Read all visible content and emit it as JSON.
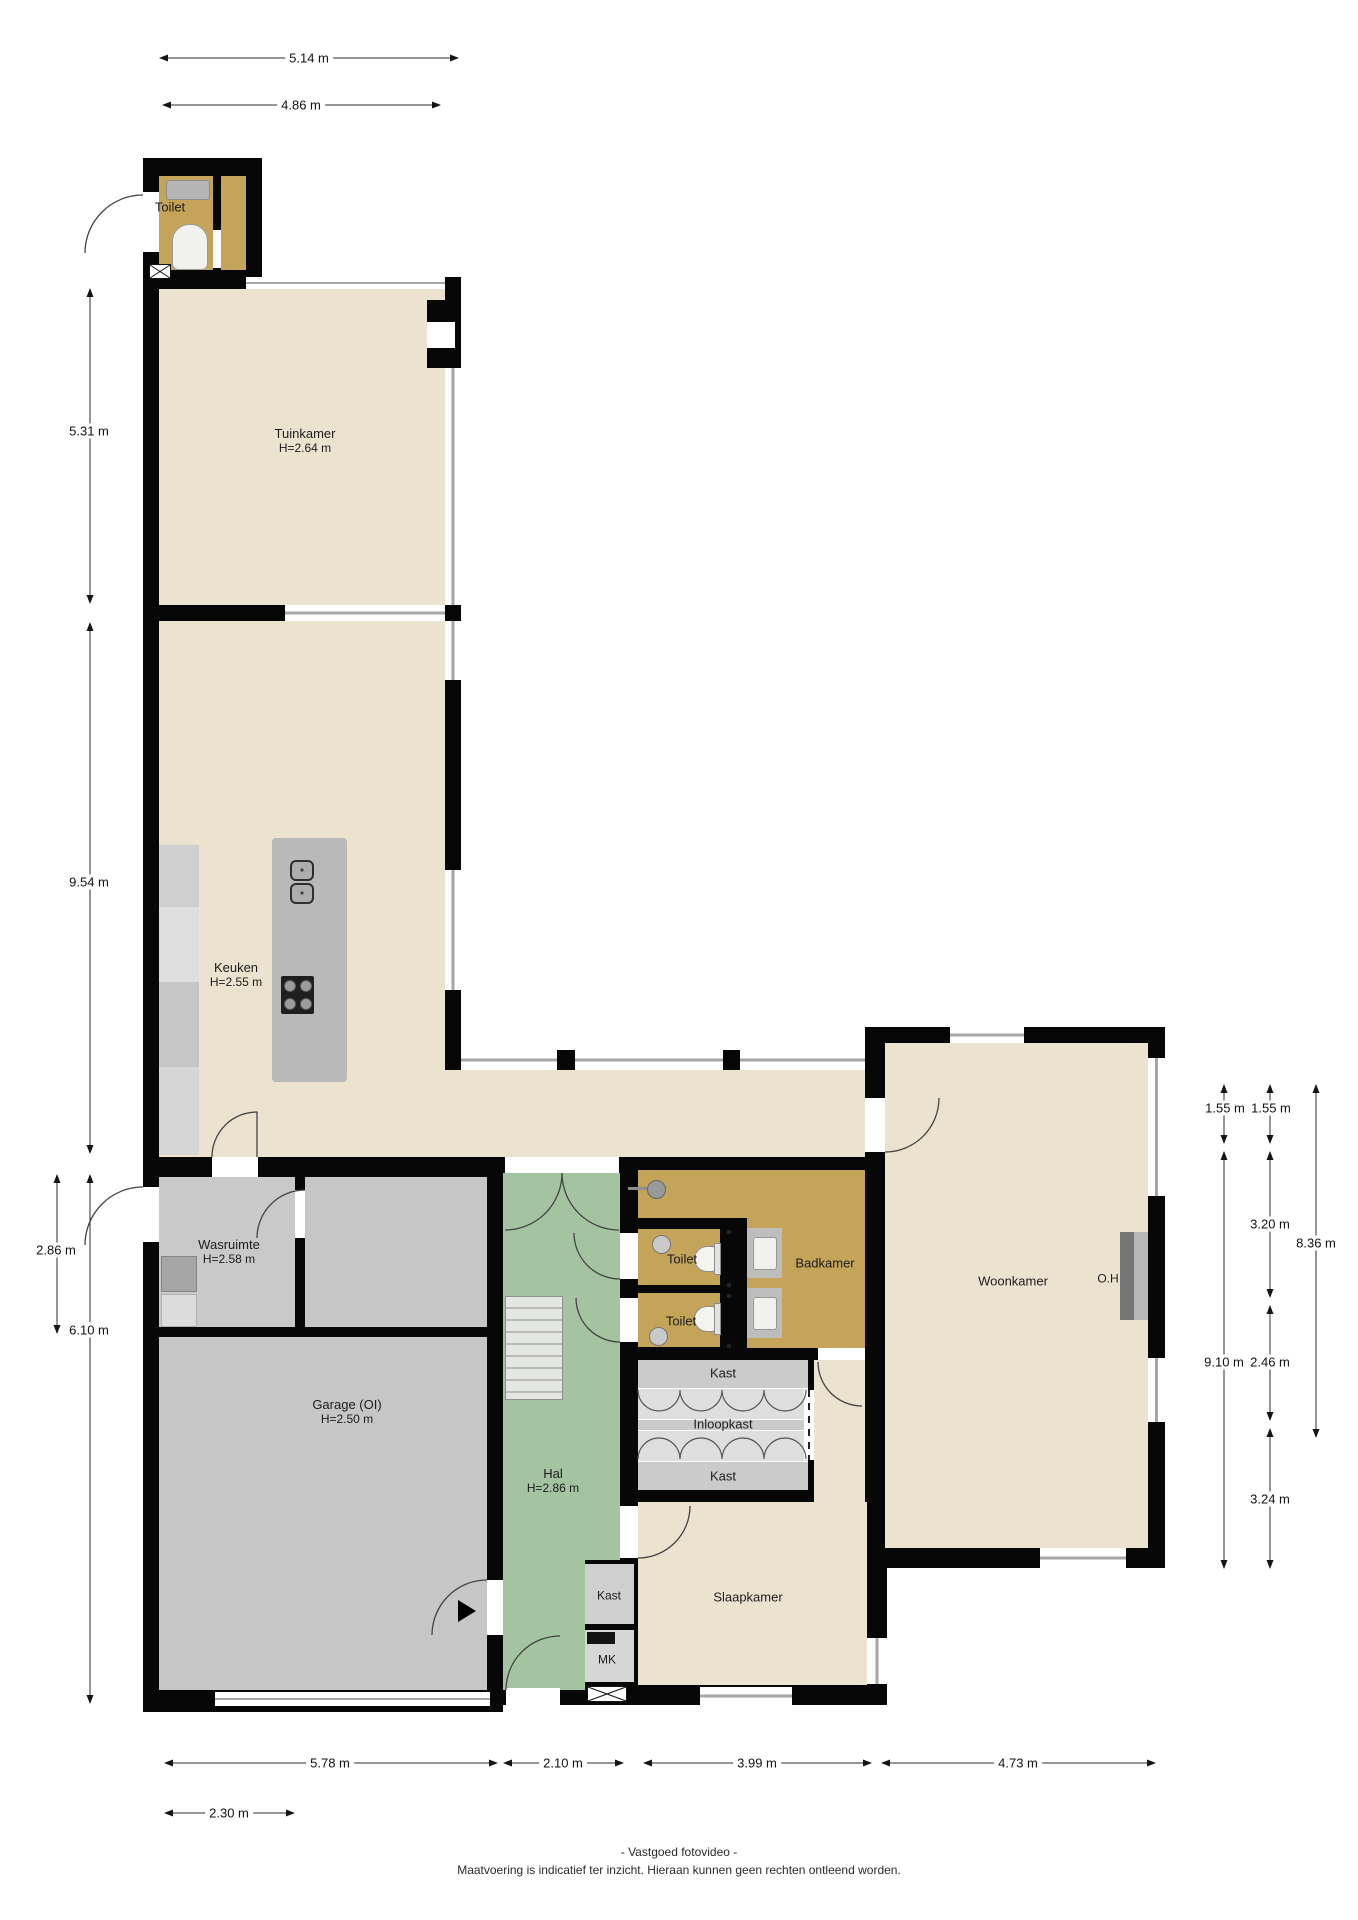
{
  "rooms": {
    "toilet_top": {
      "name": "Toilet"
    },
    "tuinkamer": {
      "name": "Tuinkamer",
      "height": "H=2.64 m"
    },
    "keuken": {
      "name": "Keuken",
      "height": "H=2.55 m"
    },
    "wasruimte": {
      "name": "Wasruimte",
      "height": "H=2.58 m"
    },
    "garage": {
      "name": "Garage (OI)",
      "height": "H=2.50 m"
    },
    "hal": {
      "name": "Hal",
      "height": "H=2.86 m"
    },
    "toilet1": {
      "name": "Toilet"
    },
    "toilet2": {
      "name": "Toilet"
    },
    "badkamer": {
      "name": "Badkamer"
    },
    "woonkamer": {
      "name": "Woonkamer"
    },
    "oh": {
      "name": "O.H"
    },
    "kast_top": {
      "name": "Kast"
    },
    "inloopkast": {
      "name": "Inloopkast"
    },
    "kast_bottom": {
      "name": "Kast"
    },
    "slaapkamer": {
      "name": "Slaapkamer"
    },
    "kast_hal": {
      "name": "Kast"
    },
    "mk": {
      "name": "MK"
    }
  },
  "dimensions": {
    "top": [
      {
        "label": "5.14 m"
      },
      {
        "label": "4.86 m"
      }
    ],
    "left": [
      {
        "label": "5.31 m"
      },
      {
        "label": "9.54 m"
      },
      {
        "label": "2.86 m"
      },
      {
        "label": "6.10 m"
      }
    ],
    "right": [
      {
        "label": "1.55 m"
      },
      {
        "label": "1.55 m"
      },
      {
        "label": "3.20 m"
      },
      {
        "label": "8.36 m"
      },
      {
        "label": "9.10 m"
      },
      {
        "label": "2.46 m"
      },
      {
        "label": "3.24 m"
      }
    ],
    "bottom": [
      {
        "label": "5.78 m"
      },
      {
        "label": "2.10 m"
      },
      {
        "label": "3.99 m"
      },
      {
        "label": "4.73 m"
      },
      {
        "label": "2.30 m"
      }
    ]
  },
  "footer": {
    "line1": "- Vastgoed fotovideo -",
    "line2": "Maatvoering is indicatief ter inzicht. Hieraan kunnen geen rechten ontleend worden."
  },
  "colors": {
    "wall": "#070707",
    "room_cream": "#EBE3D0",
    "room_gold": "#C3A458",
    "room_green": "#A4C3A1",
    "room_gray": "#C8C8C8"
  }
}
